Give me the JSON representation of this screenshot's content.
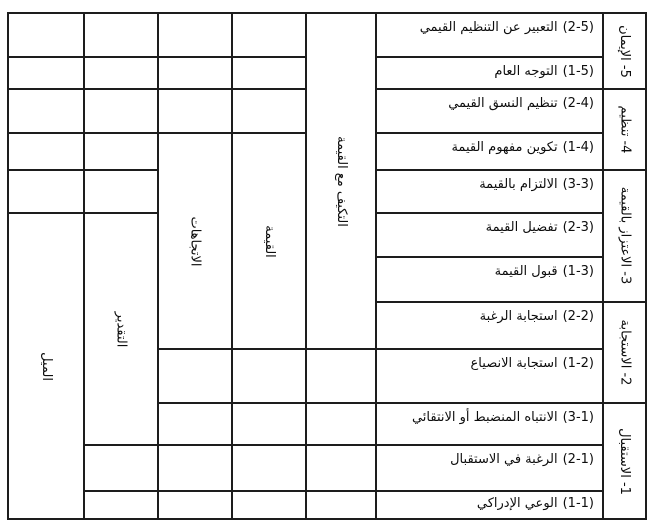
{
  "table": {
    "items": [
      {
        "num": "(2-5)",
        "text": "التعبير عن التنظيم القيمي"
      },
      {
        "num": "(1-5)",
        "text": "التوجه العام"
      },
      {
        "num": "(2-4)",
        "text": "تنظيم النسق القيمي"
      },
      {
        "num": "(1-4)",
        "text": "تكوين مفهوم القيمة"
      },
      {
        "num": "(3-3)",
        "text": "الالتزام بالقيمة"
      },
      {
        "num": "(2-3)",
        "text": "تفضيل القيمة"
      },
      {
        "num": "(1-3)",
        "text": "قبول القيمة"
      },
      {
        "num": "(2-2)",
        "text": "استجابة الرغبة"
      },
      {
        "num": "(1-2)",
        "text": "استجابة الانصياع"
      },
      {
        "num": "(3-1)",
        "text": "الانتباه المنضبط أو الانتقائي"
      },
      {
        "num": "(2-1)",
        "text": "الرغبة في الاستقبال"
      },
      {
        "num": "(1-1)",
        "text": "الوعي الإدراكي"
      }
    ],
    "levels": [
      "5- الإيمان",
      "4- تنظيم",
      "3- الاعتزاز بالقيمة",
      "2- الاستجابة",
      "1- الاستقبال"
    ],
    "categories": [
      "التكيف مع القيمة",
      "القيمة",
      "الاتجاهات",
      "التقدير",
      "الميل"
    ]
  },
  "colors": {
    "line": "#1d1d1d",
    "text": "#0d0d0d",
    "background": "#ffffff"
  }
}
